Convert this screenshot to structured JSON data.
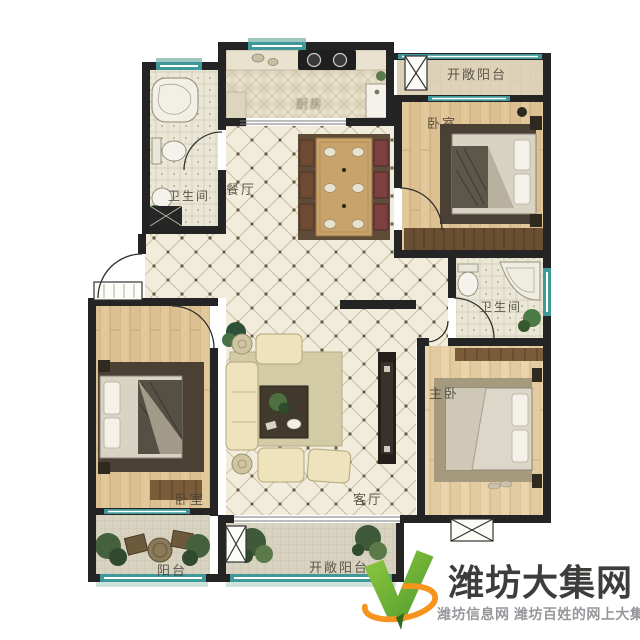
{
  "floorplan": {
    "rooms": [
      {
        "id": "bathroom-top-left",
        "label": "卫生间"
      },
      {
        "id": "kitchen",
        "label": "厨房"
      },
      {
        "id": "dining-room",
        "label": "餐厅"
      },
      {
        "id": "balcony-top-right",
        "label": "开敞阳台"
      },
      {
        "id": "bedroom-top-right",
        "label": "卧室"
      },
      {
        "id": "bathroom-right",
        "label": "卫生间"
      },
      {
        "id": "master-bedroom",
        "label": "主卧"
      },
      {
        "id": "living-room",
        "label": "客厅"
      },
      {
        "id": "bedroom-left",
        "label": "卧室"
      },
      {
        "id": "balcony-left",
        "label": "阳台"
      },
      {
        "id": "balcony-bottom",
        "label": "开敞阳台"
      }
    ],
    "colors": {
      "wall": "#242424",
      "window_glass": "#3f989a",
      "tile_floor": "#f1ecdc",
      "wood_floor": "#e2c99c"
    }
  },
  "watermark": {
    "title": "潍坊大集网",
    "subtitle": "潍坊信息网 潍坊百姓的网上大集",
    "logo": "v-check-logo",
    "colors": {
      "green": "#5fae34",
      "orange": "#f7941d",
      "title_text": "#3d3d3b",
      "subtitle_text": "#97979b"
    }
  }
}
